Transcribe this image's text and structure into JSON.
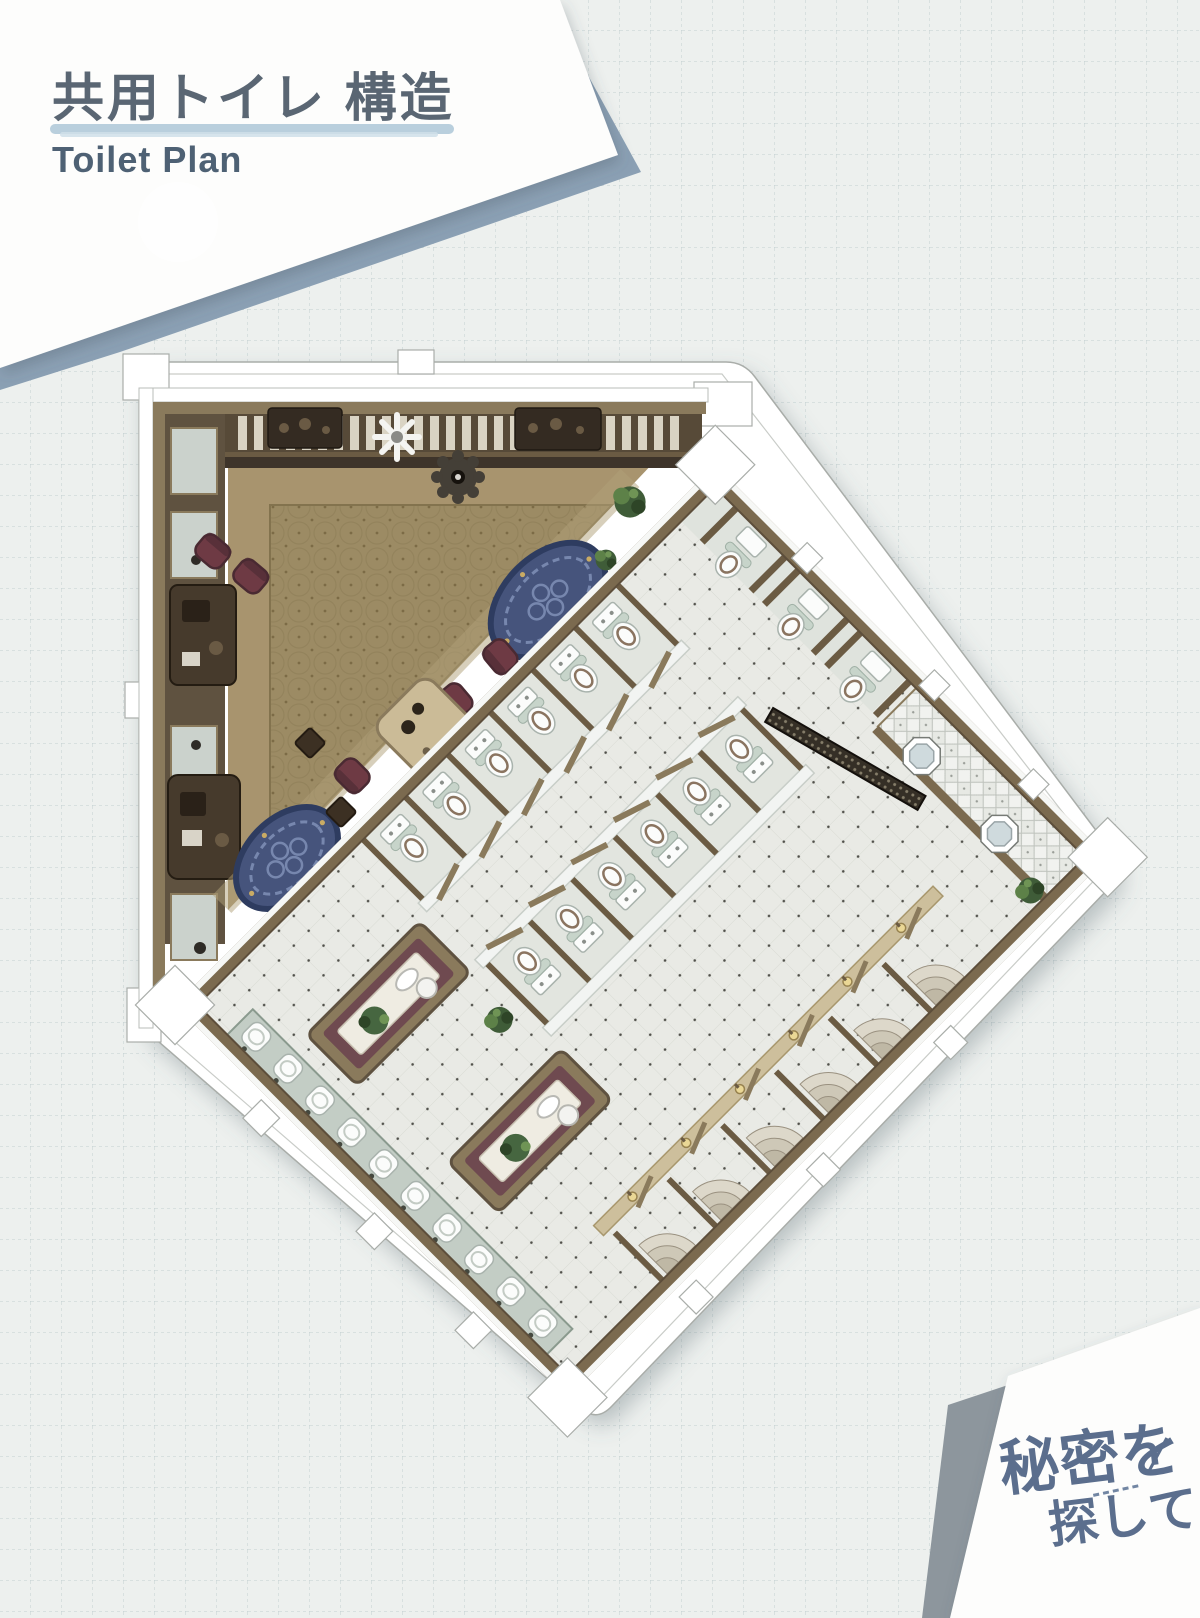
{
  "header": {
    "title_jp": "共用トイレ 構造",
    "subtitle_en": "Toilet Plan"
  },
  "logo": {
    "line1": "秘密を",
    "line2": "探して"
  },
  "palette": {
    "paper": "#edf0ee",
    "grid_line": "#b4c4c5",
    "sheet_white": "#fdfdfc",
    "sheet_accent_blue": "#8ba0b4",
    "sheet_accent_gray": "#8d969d",
    "title_text": "#5a6673",
    "title_underline": "#b9cfdd",
    "subtitle_text": "#4e6174",
    "logo_text": "#5b6e8d",
    "sticker_white": "#ffffff",
    "wood_dark": "#5d4e3b",
    "wood_mid": "#7b6a4f",
    "wood_light": "#a5916c",
    "carpet": "#9c8b64",
    "carpet_motif": "#8b7a53",
    "tile": "#e9eae5",
    "tile_dot": "#50504a",
    "partition_white": "#f2f4f2",
    "glass_green": "#c7d4ca",
    "fixture_white": "#fbfcfb",
    "rug_navy": "#46547c",
    "rug_border": "#2e3c60",
    "rug_pattern": "#7787ae",
    "chair_maroon": "#6e3a44",
    "plant_green": "#3f5c38",
    "counter_beige": "#cbbb97",
    "screen_dark": "#352f26",
    "steps_tan": "#d8d3c5",
    "lamp_gold": "#ead795",
    "slat": "#d9d3c3"
  },
  "plan": {
    "lounge": {
      "oval_rugs": 2,
      "armchairs": 5,
      "side_tables": 2,
      "window_slats": 28,
      "mirror_panels": 6,
      "wall_consoles": 2,
      "vanity_consoles": 2,
      "ceiling_fixtures": 2,
      "plants": 3,
      "service_counters": 1
    },
    "toilet_wing": {
      "stall_rows": 2,
      "stalls_per_row": 6,
      "washbasins": 10,
      "vanity_islands": 2,
      "vip_toilets": 3,
      "urinal_mirrors": 2,
      "privacy_screens": 1,
      "corner_step_stalls": 6,
      "wall_lamps": 6,
      "plants": 2
    }
  }
}
